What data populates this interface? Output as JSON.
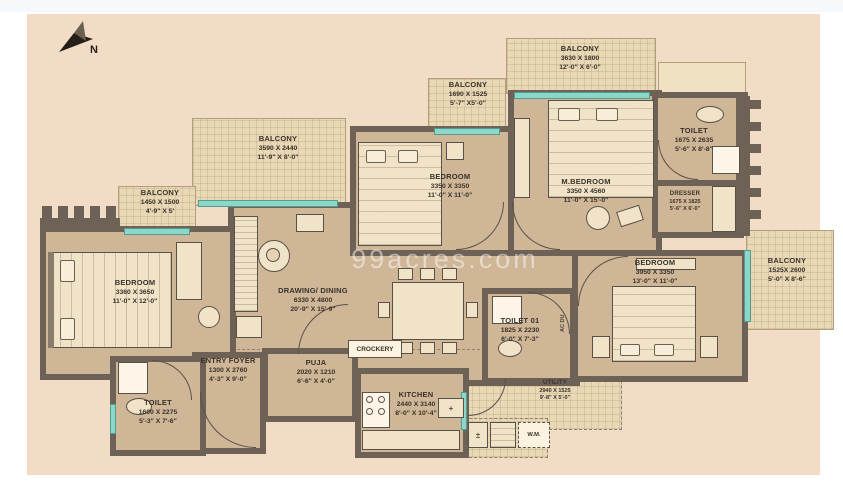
{
  "watermark": "99acres.com",
  "annotations": {
    "compass": "N",
    "crockery": "CROCKERY",
    "washing_machine": "W.M.",
    "ac_duct": "AC DU"
  },
  "rooms": {
    "balcony_tr": {
      "name": "BALCONY",
      "mm": "3630 X 1800",
      "ft": "12'-0\" X 6'-0\""
    },
    "balcony_tm": {
      "name": "BALCONY",
      "mm": "1690 X 1525",
      "ft": "5'-7\" X5'-0\""
    },
    "balcony_tl": {
      "name": "BALCONY",
      "mm": "3590 X 2440",
      "ft": "11'-9\" X 8'-0\""
    },
    "balcony_l": {
      "name": "BALCONY",
      "mm": "1450 X 1500",
      "ft": "4'-9\" X 5'"
    },
    "balcony_r": {
      "name": "BALCONY",
      "mm": "1525X 2600",
      "ft": "5'-0\" X 8'-6\""
    },
    "bedroom_tm": {
      "name": "BEDROOM",
      "mm": "3350 X 3350",
      "ft": "11'-0\" X 11'-0\""
    },
    "m_bedroom": {
      "name": "M.BEDROOM",
      "mm": "3350 X 4560",
      "ft": "11'-0\" X 15'-0\""
    },
    "toilet_tr": {
      "name": "TOILET",
      "mm": "1675 X 2635",
      "ft": "5'-6\" X 8'-8\""
    },
    "dresser": {
      "name": "DRESSER",
      "mm": "1675 X 1825",
      "ft": "5'-6\" X 6'-0\""
    },
    "bedroom_r": {
      "name": "BEDROOM",
      "mm": "3950 X 3350",
      "ft": "13'-0\" X 11'-0\""
    },
    "bedroom_l": {
      "name": "BEDROOM",
      "mm": "3360 X 3650",
      "ft": "11'-0\" X 12'-0\""
    },
    "drawing": {
      "name": "DRAWING/ DINING",
      "mm": "6330 X 4800",
      "ft": "20'-9\" X 15'-9\""
    },
    "toilet_01": {
      "name": "TOILET 01",
      "mm": "1825 X 2230",
      "ft": "6'-0\" X 7'-3\""
    },
    "entry_foyer": {
      "name": "ENTRY FOYER",
      "mm": "1300 X 2760",
      "ft": "4'-3\" X 9'-0\""
    },
    "puja": {
      "name": "PUJA",
      "mm": "2020 X 1210",
      "ft": "6'-6\" X 4'-0\""
    },
    "kitchen": {
      "name": "KITCHEN",
      "mm": "2440 X 3140",
      "ft": "8'-0\" X 10'-4\""
    },
    "toilet_bl": {
      "name": "TOILET",
      "mm": "1600 X 2275",
      "ft": "5'-3\" X 7'-6\""
    },
    "utility": {
      "name": "UTILITY",
      "mm": "2940 X 1525",
      "ft": "9'-8\" X 5'-0\""
    }
  },
  "colors": {
    "background": "#f2dcc6",
    "floor": "#cfb697",
    "balcony": "#e9d8b6",
    "wall": "#6e6257",
    "window": "#8ed6c9",
    "furniture": "#f1e3c8",
    "text": "#38322b"
  }
}
